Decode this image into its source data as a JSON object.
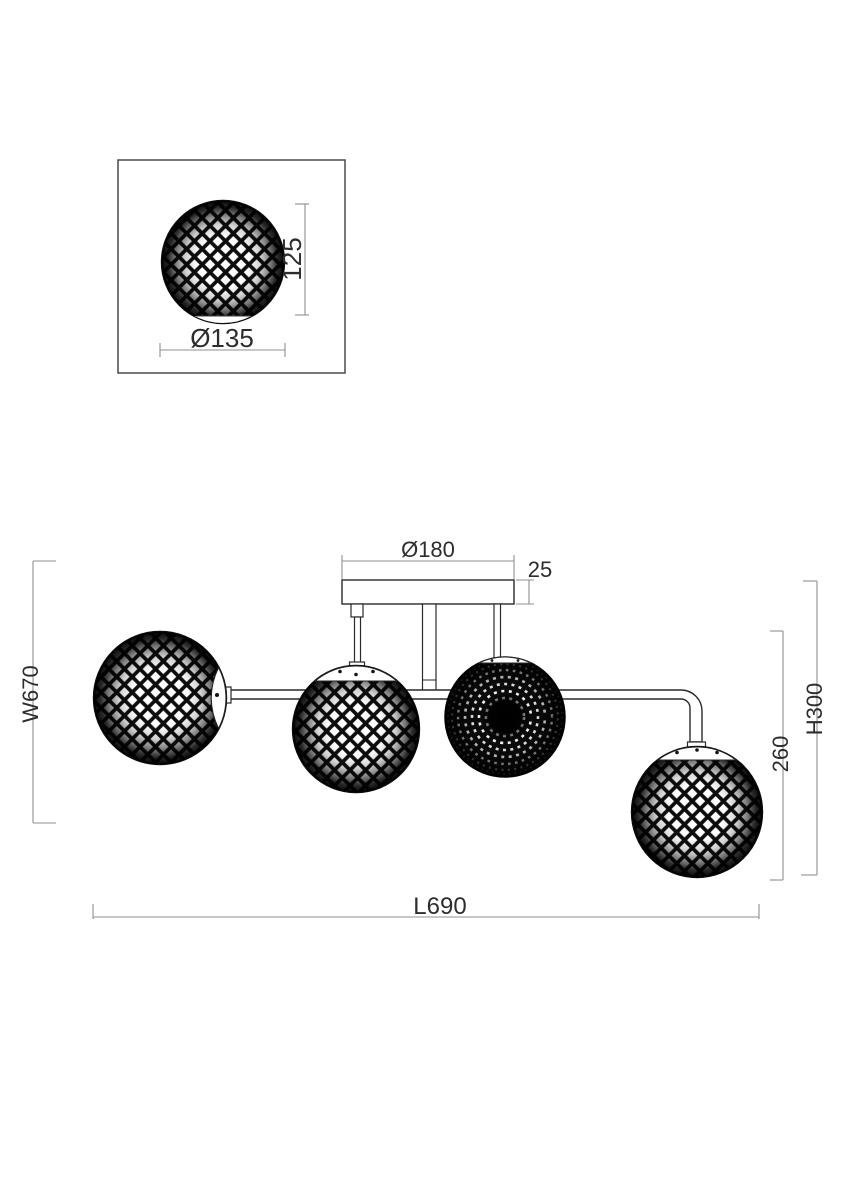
{
  "drawing": {
    "detail_view": {
      "globe_height_label": "125",
      "globe_diameter_label": "Ø135"
    },
    "main_view": {
      "canopy_diameter_label": "Ø180",
      "canopy_thickness_label": "25",
      "width_label": "W670",
      "overall_height_label": "H300",
      "drop_height_label": "260",
      "length_label": "L690"
    },
    "colors": {
      "background": "#ffffff",
      "fixture_outline": "#2a2a2a",
      "lattice_fill": "#0c0c0c",
      "dimension_line": "#8f8f8f",
      "dimension_text": "#2d2d2d"
    }
  }
}
